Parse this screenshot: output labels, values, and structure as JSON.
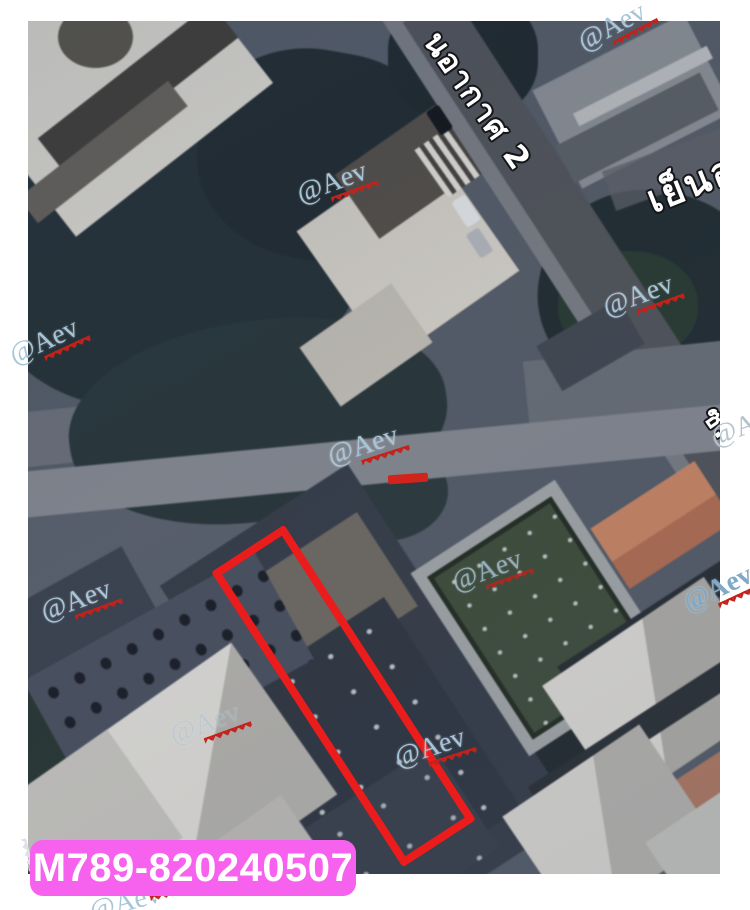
{
  "watermarks": {
    "text": "@Aev",
    "color": "#a7c5d8",
    "zigzag_color": "#c32119",
    "count": 12
  },
  "map_photo": {
    "road_labels": [
      {
        "text": "นอากาศ 2"
      },
      {
        "text": "เย็นอ"
      },
      {
        "text": "ซ. เ"
      }
    ],
    "plot_outline_color": "#ea1c1c"
  },
  "listing_label": {
    "text": "M789-820240507",
    "bg": "#f661ee",
    "fg": "#ffffff"
  }
}
